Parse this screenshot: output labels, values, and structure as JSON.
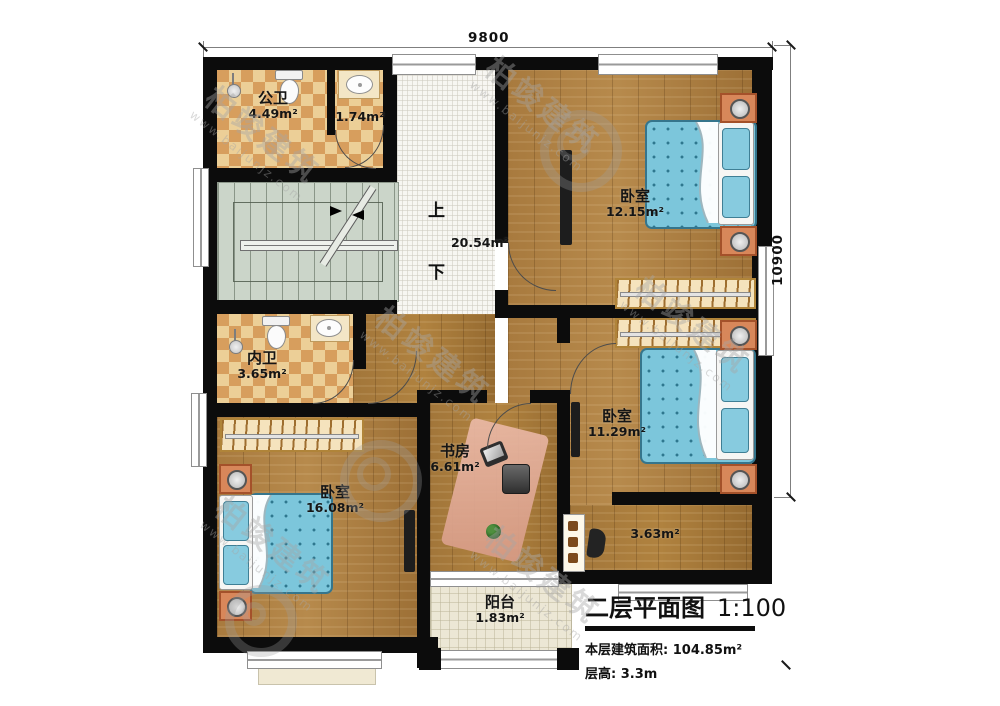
{
  "dimensions": {
    "top": "9800",
    "right": "10900"
  },
  "stairs": {
    "up": "上",
    "down": "下"
  },
  "rooms": {
    "public_bath": {
      "name": "公卫",
      "area": "4.49m²"
    },
    "small_bath": {
      "area": "1.74m²"
    },
    "hallway": {
      "area": "20.54m²"
    },
    "bedroom_top": {
      "name": "卧室",
      "area": "12.15m²"
    },
    "inner_bath": {
      "name": "内卫",
      "area": "3.65m²"
    },
    "study": {
      "name": "书房",
      "area": "6.61m²"
    },
    "bedroom_right": {
      "name": "卧室",
      "area": "11.29m²"
    },
    "bedroom_left": {
      "name": "卧室",
      "area": "16.08m²"
    },
    "corridor": {
      "area": "3.63m²"
    },
    "balcony": {
      "name": "阳台",
      "area": "1.83m²"
    }
  },
  "title_block": {
    "title": "二层平面图",
    "scale": "1:100",
    "area_line": "本层建筑面积: 104.85m²",
    "height_line": "层高: 3.3m"
  },
  "watermark": {
    "brand": "柏竣建筑",
    "url": "www.baijunjz.com"
  },
  "colors": {
    "wall": "#0c0c0c",
    "wood": "#a87a3e",
    "checker_light": "#eccf97",
    "checker_dark": "#d79e5d",
    "stair": "#cbd5c9",
    "bed": "#7cc6db",
    "balcony": "#ece7d5"
  }
}
